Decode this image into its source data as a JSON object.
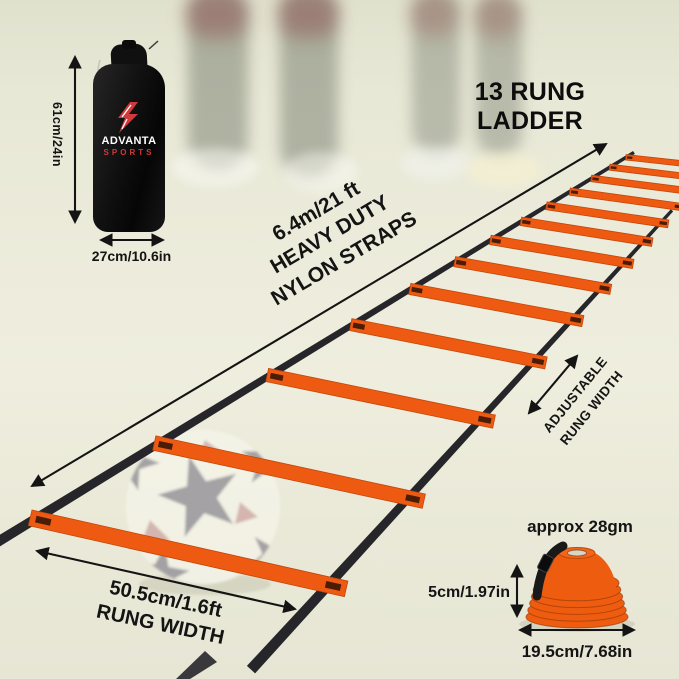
{
  "title": "13 RUNG LADDER",
  "bag": {
    "brand_top": "ADVANTA",
    "brand_bottom": "SPORTS",
    "height": "61cm/24in",
    "width": "27cm/10.6in"
  },
  "ladder": {
    "rung_count": 13,
    "length_label": "6.4m/21 ft",
    "duty_label": "HEAVY DUTY",
    "strap_label": "NYLON STRAPS",
    "adjust_line1": "ADJUSTABLE",
    "adjust_line2": "RUNG WIDTH",
    "rung_width_value": "50.5cm/1.6ft",
    "rung_width_label": "RUNG WIDTH",
    "colors": {
      "rung": "#ee5a12",
      "strap": "#26262a"
    }
  },
  "cones": {
    "weight": "approx 28gm",
    "height": "5cm/1.97in",
    "diameter": "19.5cm/7.68in",
    "color": "#ee5c10"
  },
  "logo_colors": {
    "red": "#d03a3a"
  }
}
